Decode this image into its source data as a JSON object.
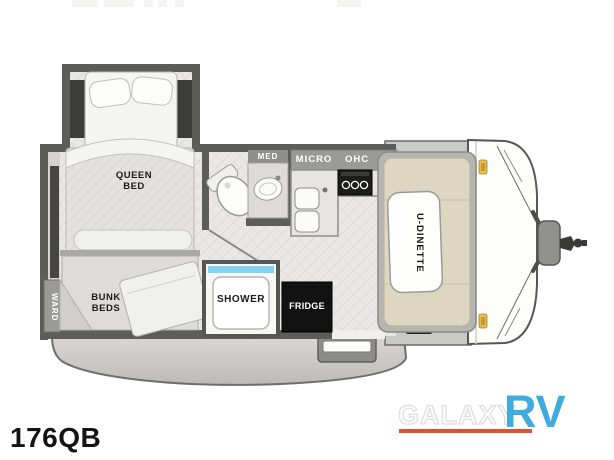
{
  "floorplan": {
    "model": "176QB",
    "rooms": {
      "queen_bed": {
        "line1": "QUEEN",
        "line2": "BED"
      },
      "bunk_beds": {
        "line1": "BUNK",
        "line2": "BEDS"
      },
      "wardrobe": "WARD",
      "medicine_cabinet": "MED",
      "microwave": "MICRO",
      "overhead_cabinet": "OHC",
      "shower": "SHOWER",
      "fridge": "FRIDGE",
      "dinette": "U-DINETTE"
    }
  },
  "branding": {
    "dealer_name": "GALAXY",
    "dealer_suffix": "RV"
  },
  "colors": {
    "logo_blue": "#41aade",
    "logo_orange": "#e2512c",
    "marker_light_amber": "#e5c04f",
    "shower_pan_blue": "#7fd4f0",
    "wall_gray": "#5c5c5a",
    "cushion_tan": "#ddd6c0",
    "fridge_black": "#121212"
  }
}
